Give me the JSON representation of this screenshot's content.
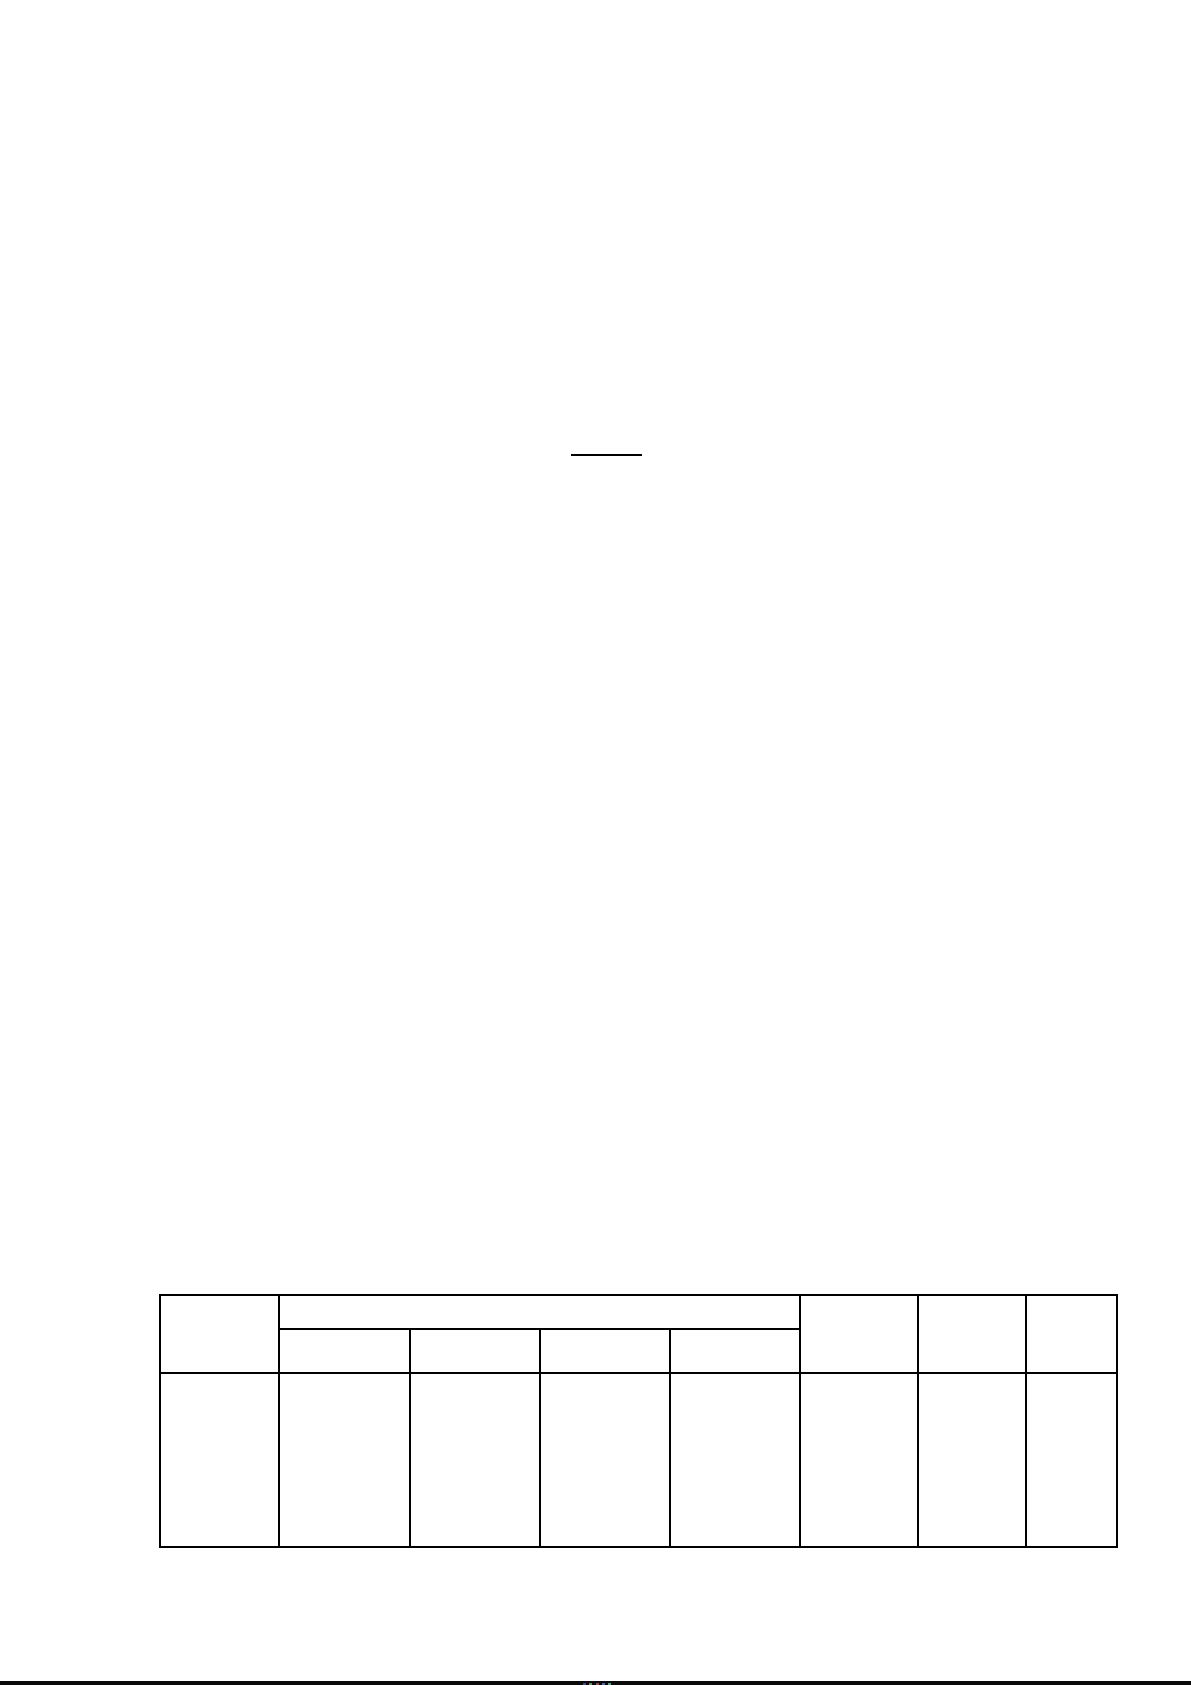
{
  "page": {
    "background": "#ffffff",
    "width_px": 1191,
    "height_px": 1685
  },
  "document": {
    "blank_underline": {
      "text": "",
      "color": "#000000"
    },
    "table": {
      "border_color": "#000000",
      "columns": 8,
      "column_widths_px": [
        119,
        131,
        130,
        130,
        130,
        118,
        108,
        91
      ],
      "row_heights_px": [
        36,
        46,
        176
      ],
      "header": {
        "corner_cell": "",
        "merged_header_cell": "",
        "sub_header_cells": [
          "",
          "",
          "",
          ""
        ],
        "right_header_cells": [
          "",
          "",
          ""
        ]
      },
      "body_row_cells": [
        "",
        "",
        "",
        "",
        "",
        "",
        "",
        ""
      ]
    }
  },
  "bottom_edge": {
    "bar_color": "#0a0a0a",
    "artifact_dot_colors": [
      "#4444aa",
      "#44aa44",
      "#aa4444",
      "#4466bb",
      "#44aa88"
    ]
  }
}
